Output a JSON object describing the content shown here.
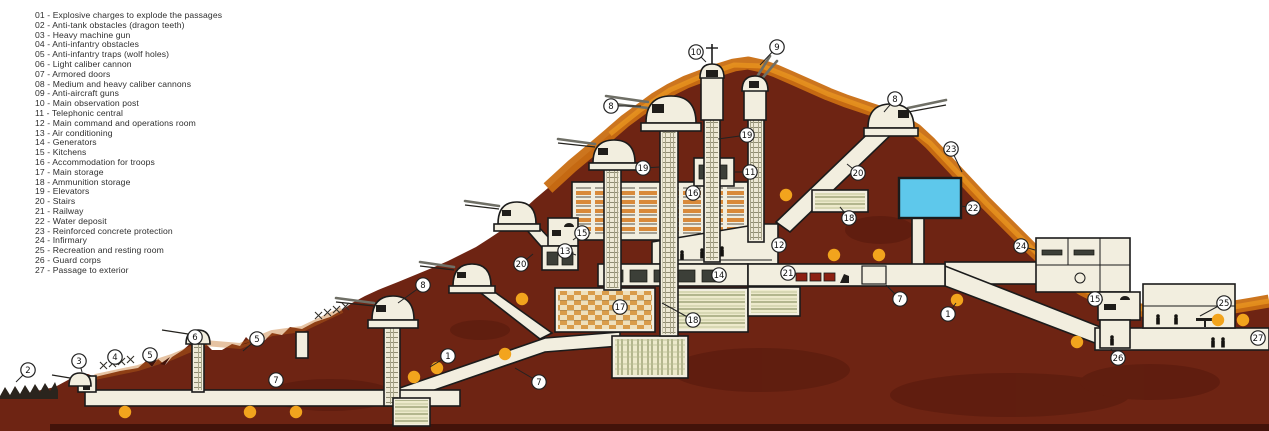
{
  "legend": {
    "items": [
      {
        "num": "01",
        "label": "Explosive charges to explode the passages"
      },
      {
        "num": "02",
        "label": "Anti-tank obstacles (dragon teeth)"
      },
      {
        "num": "03",
        "label": "Heavy machine gun"
      },
      {
        "num": "04",
        "label": "Anti-infantry obstacles"
      },
      {
        "num": "05",
        "label": "Anti-infantry traps (wolf holes)"
      },
      {
        "num": "06",
        "label": "Light caliber cannon"
      },
      {
        "num": "07",
        "label": "Armored doors"
      },
      {
        "num": "08",
        "label": "Medium and heavy caliber cannons"
      },
      {
        "num": "09",
        "label": "Anti-aircraft guns"
      },
      {
        "num": "10",
        "label": "Main observation post"
      },
      {
        "num": "11",
        "label": "Telephonic central"
      },
      {
        "num": "12",
        "label": "Main command and operations room"
      },
      {
        "num": "13",
        "label": "Air conditioning"
      },
      {
        "num": "14",
        "label": "Generators"
      },
      {
        "num": "15",
        "label": "Kitchens"
      },
      {
        "num": "16",
        "label": "Accommodation for troops"
      },
      {
        "num": "17",
        "label": "Main storage"
      },
      {
        "num": "18",
        "label": "Ammunition storage"
      },
      {
        "num": "19",
        "label": "Elevators"
      },
      {
        "num": "20",
        "label": "Stairs"
      },
      {
        "num": "21",
        "label": "Railway"
      },
      {
        "num": "22",
        "label": "Water deposit"
      },
      {
        "num": "23",
        "label": "Reinforced concrete protection"
      },
      {
        "num": "24",
        "label": "Infirmary"
      },
      {
        "num": "25",
        "label": "Recreation and resting room"
      },
      {
        "num": "26",
        "label": "Guard corps"
      },
      {
        "num": "27",
        "label": "Passage to exterior"
      }
    ]
  },
  "diagram": {
    "colors": {
      "mountain": "#6E2413",
      "mountain_dark": "#50170B",
      "ridge_orange": "#C96E12",
      "ridge_orange_light": "#E8951F",
      "structure": "#F2EEDF",
      "outline": "#1B1B1B",
      "water": "#5EC8EB",
      "charge_dot": "#F2A41D",
      "rail_car": "#8C2012"
    },
    "callouts": [
      {
        "n": "1",
        "x": 448,
        "y": 356,
        "line": [
          430,
          367
        ]
      },
      {
        "n": "1",
        "x": 948,
        "y": 314,
        "line": [
          956,
          303
        ]
      },
      {
        "n": "2",
        "x": 28,
        "y": 370,
        "line": [
          16,
          382
        ]
      },
      {
        "n": "3",
        "x": 79,
        "y": 361,
        "line": [
          82,
          372
        ]
      },
      {
        "n": "4",
        "x": 115,
        "y": 357,
        "line": [
          117,
          365
        ]
      },
      {
        "n": "5",
        "x": 150,
        "y": 355,
        "line": [
          152,
          362
        ]
      },
      {
        "n": "5",
        "x": 257,
        "y": 339,
        "line": [
          243,
          351
        ]
      },
      {
        "n": "6",
        "x": 195,
        "y": 337,
        "line": [
          197,
          343
        ]
      },
      {
        "n": "7",
        "x": 276,
        "y": 380
      },
      {
        "n": "7",
        "x": 539,
        "y": 382,
        "line": [
          515,
          368
        ]
      },
      {
        "n": "7",
        "x": 900,
        "y": 299,
        "line": [
          886,
          285
        ]
      },
      {
        "n": "8",
        "x": 423,
        "y": 285,
        "line": [
          398,
          303
        ]
      },
      {
        "n": "8",
        "x": 611,
        "y": 106,
        "line": [
          641,
          106
        ]
      },
      {
        "n": "8",
        "x": 895,
        "y": 99,
        "line": [
          884,
          112
        ]
      },
      {
        "n": "9",
        "x": 777,
        "y": 47,
        "line": [
          760,
          65
        ]
      },
      {
        "n": "10",
        "x": 696,
        "y": 52,
        "line": [
          706,
          62
        ]
      },
      {
        "n": "11",
        "x": 750,
        "y": 172,
        "line": [
          735,
          172
        ]
      },
      {
        "n": "12",
        "x": 779,
        "y": 245
      },
      {
        "n": "13",
        "x": 565,
        "y": 251,
        "line": [
          576,
          255
        ]
      },
      {
        "n": "14",
        "x": 719,
        "y": 275
      },
      {
        "n": "15",
        "x": 582,
        "y": 233,
        "line": [
          573,
          240
        ]
      },
      {
        "n": "15",
        "x": 1095,
        "y": 299,
        "line": [
          1103,
          300
        ]
      },
      {
        "n": "16",
        "x": 693,
        "y": 193
      },
      {
        "n": "17",
        "x": 620,
        "y": 307
      },
      {
        "n": "18",
        "x": 849,
        "y": 218,
        "line": [
          840,
          207
        ]
      },
      {
        "n": "18",
        "x": 693,
        "y": 320,
        "line": [
          662,
          303
        ]
      },
      {
        "n": "19",
        "x": 643,
        "y": 168,
        "line": [
          660,
          167
        ]
      },
      {
        "n": "19",
        "x": 747,
        "y": 135,
        "line": [
          718,
          139
        ]
      },
      {
        "n": "20",
        "x": 521,
        "y": 264,
        "line": [
          533,
          254
        ]
      },
      {
        "n": "20",
        "x": 858,
        "y": 173,
        "line": [
          847,
          164
        ]
      },
      {
        "n": "21",
        "x": 788,
        "y": 273
      },
      {
        "n": "22",
        "x": 973,
        "y": 208,
        "line": [
          961,
          206
        ]
      },
      {
        "n": "23",
        "x": 951,
        "y": 149,
        "line": [
          962,
          172
        ]
      },
      {
        "n": "24",
        "x": 1021,
        "y": 246,
        "line": [
          1035,
          250
        ]
      },
      {
        "n": "25",
        "x": 1224,
        "y": 303,
        "line": [
          1200,
          316
        ]
      },
      {
        "n": "26",
        "x": 1118,
        "y": 358,
        "line": [
          1111,
          349
        ]
      },
      {
        "n": "27",
        "x": 1258,
        "y": 338
      }
    ],
    "charges": [
      [
        125,
        412
      ],
      [
        250,
        412
      ],
      [
        296,
        412
      ],
      [
        414,
        377
      ],
      [
        437,
        368
      ],
      [
        505,
        354
      ],
      [
        522,
        299
      ],
      [
        786,
        195
      ],
      [
        834,
        255
      ],
      [
        879,
        255
      ],
      [
        957,
        300
      ],
      [
        1077,
        342
      ],
      [
        1218,
        320
      ],
      [
        1243,
        320
      ]
    ]
  }
}
